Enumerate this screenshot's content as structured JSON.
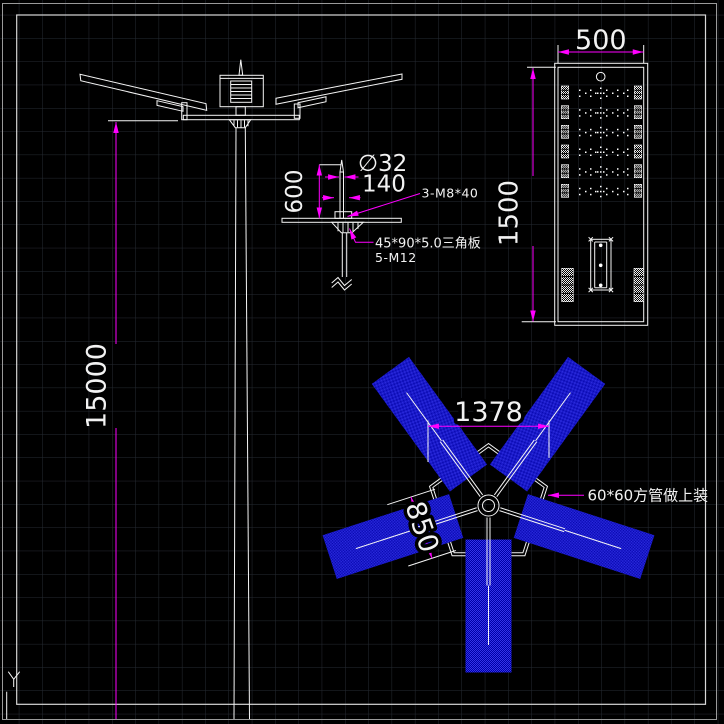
{
  "canvas": {
    "bg": "#000000",
    "grid_color": "#262b33",
    "line_color": "#f5f5f5",
    "dim_color": "#ff00ff",
    "blade_color": "#1a1ad0"
  },
  "elevation": {
    "height_dim": "15000"
  },
  "bracket_detail": {
    "len_dim": "600",
    "dia_dim": "∅32",
    "width_dim": "140",
    "bolt_label": "3-M8*40",
    "plate_label": "45*90*5.0三角板",
    "anchor_label": "5-M12"
  },
  "panel_detail": {
    "width_dim": "500",
    "height_dim": "1500"
  },
  "plan_view": {
    "span_dim": "1378",
    "blade_dim": "850",
    "tube_label": "60*60方管做上装"
  },
  "ucs": {
    "y_label": "Y"
  }
}
